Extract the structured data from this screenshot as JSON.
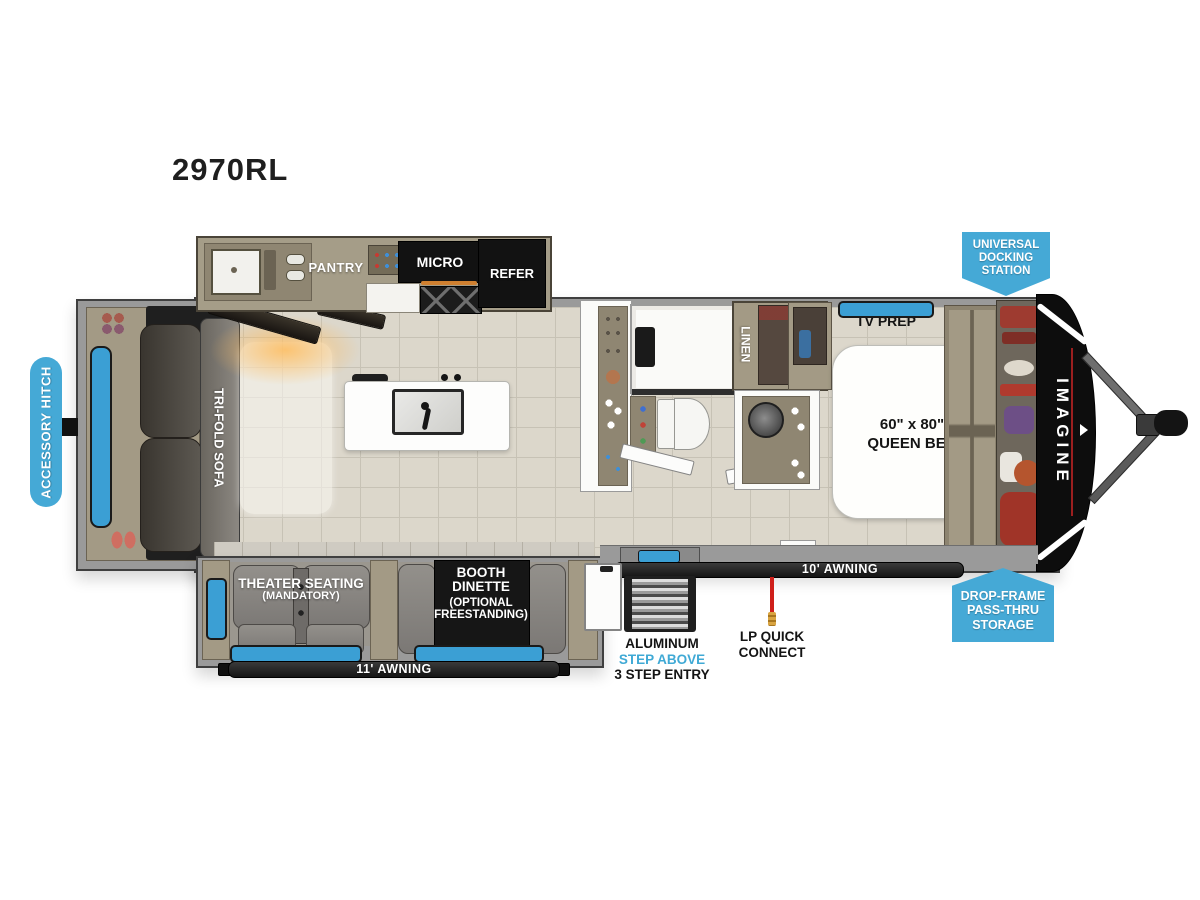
{
  "title": "2970RL",
  "kitchen": {
    "pantry": "PANTRY",
    "micro": "MICRO",
    "refer": "REFER"
  },
  "living": {
    "sofa": "TRI-FOLD SOFA",
    "theater1": "THEATER SEATING",
    "theater2": "(MANDATORY)",
    "dinette1": "BOOTH",
    "dinette2": "DINETTE",
    "dinette3": "(OPTIONAL",
    "dinette4": "FREESTANDING)"
  },
  "bath": {
    "linen": "LINEN"
  },
  "bedroom": {
    "tv_prep": "TV PREP",
    "bed1": "60\" x 80\"",
    "bed2": "QUEEN BED"
  },
  "exterior": {
    "awning_11": "11' AWNING",
    "awning_10": "10' AWNING",
    "entry1": "ALUMINUM",
    "entry2": "STEP ABOVE",
    "entry3": "3 STEP ENTRY",
    "lp1": "LP QUICK",
    "lp2": "CONNECT",
    "brand": "IMAGINE"
  },
  "badges": {
    "docking1": "UNIVERSAL",
    "docking2": "DOCKING",
    "docking3": "STATION",
    "storage1": "DROP-FRAME",
    "storage2": "PASS-THRU",
    "storage3": "STORAGE",
    "hitch": "ACCESSORY HITCH"
  },
  "colors": {
    "badge_blue": "#45a9d6",
    "window_blue": "#3b9fd4",
    "accent_red": "#c9241c",
    "step_text_blue": "#3fa9d5"
  }
}
